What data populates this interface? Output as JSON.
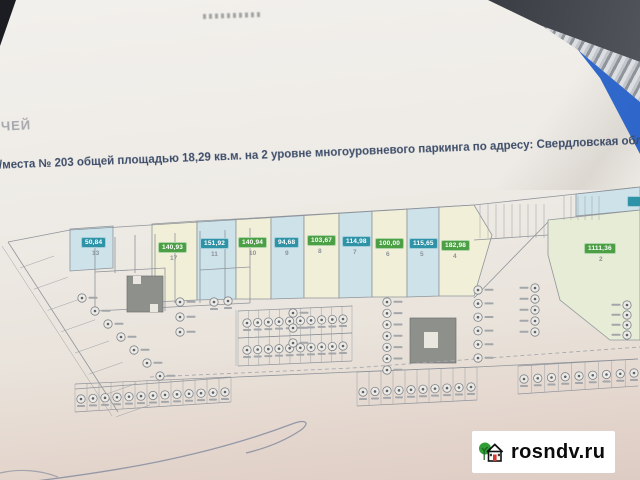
{
  "document": {
    "partial_word_top_left": "ЧЕЙ",
    "description_line": "о/места № 203 общей площадью 18,29 кв.м. на 2 уровне многоуровневого паркинга по адресу: Свердловская облас"
  },
  "plan": {
    "badge_colors": {
      "teal": "#2f93a8",
      "green": "#4c9f44"
    },
    "units": [
      {
        "area": "50,84",
        "number": "13",
        "color": "teal"
      },
      {
        "area": "140,93",
        "number": "17",
        "color": "green"
      },
      {
        "area": "151,92",
        "number": "11",
        "color": "teal"
      },
      {
        "area": "140,94",
        "number": "10",
        "color": "green"
      },
      {
        "area": "94,68",
        "number": "9",
        "color": "teal"
      },
      {
        "area": "103,67",
        "number": "8",
        "color": "green"
      },
      {
        "area": "114,98",
        "number": "7",
        "color": "teal"
      },
      {
        "area": "100,00",
        "number": "6",
        "color": "green"
      },
      {
        "area": "115,65",
        "number": "5",
        "color": "teal"
      },
      {
        "area": "182,98",
        "number": "4",
        "color": "green"
      },
      {
        "area": "1111,36",
        "number": "2",
        "color": "green"
      }
    ]
  },
  "watermark": {
    "site": "rosndv.ru"
  }
}
